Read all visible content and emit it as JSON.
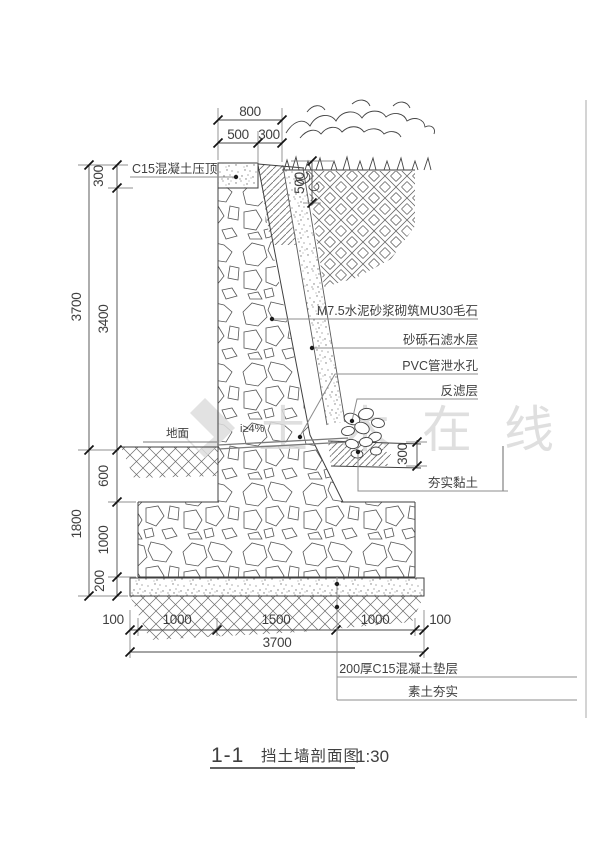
{
  "title": {
    "ref": "1-1",
    "name": "挡土墙剖面图",
    "scale": "1:30"
  },
  "watermark": {
    "text": "土木在线"
  },
  "callouts": {
    "cap": "C15混凝土压顶",
    "masonry": "M7.5水泥砂浆砌筑MU30毛石",
    "gravel_filter": "砂砾石滤水层",
    "pvc_weep": "PVC管泄水孔",
    "inverted_filter": "反滤层",
    "compacted_clay": "夯实黏土",
    "concrete_pad": "200厚C15混凝土垫层",
    "compacted_subsoil": "素土夯实",
    "ground": "地面",
    "slope": "i≥4%"
  },
  "dimensions": {
    "top": {
      "total": "800",
      "cap_width": "500",
      "drain_width": "300"
    },
    "planting_depth": "500",
    "left": {
      "cap_height": "300",
      "wall_above_ground": "3700",
      "stem_height": "3400",
      "embed_depth": "600",
      "footing_height": "1000",
      "pad_thickness": "200",
      "below_ground_total": "1800"
    },
    "clay_thickness": "300",
    "bottom": {
      "margin_left": "100",
      "seg1": "1000",
      "seg2": "1500",
      "seg3": "1000",
      "margin_right": "100",
      "total": "3700"
    }
  },
  "colors": {
    "line": "#3f3f3f",
    "leader": "#8c8c8c",
    "watermark": "#dadada",
    "background": "#ffffff"
  }
}
